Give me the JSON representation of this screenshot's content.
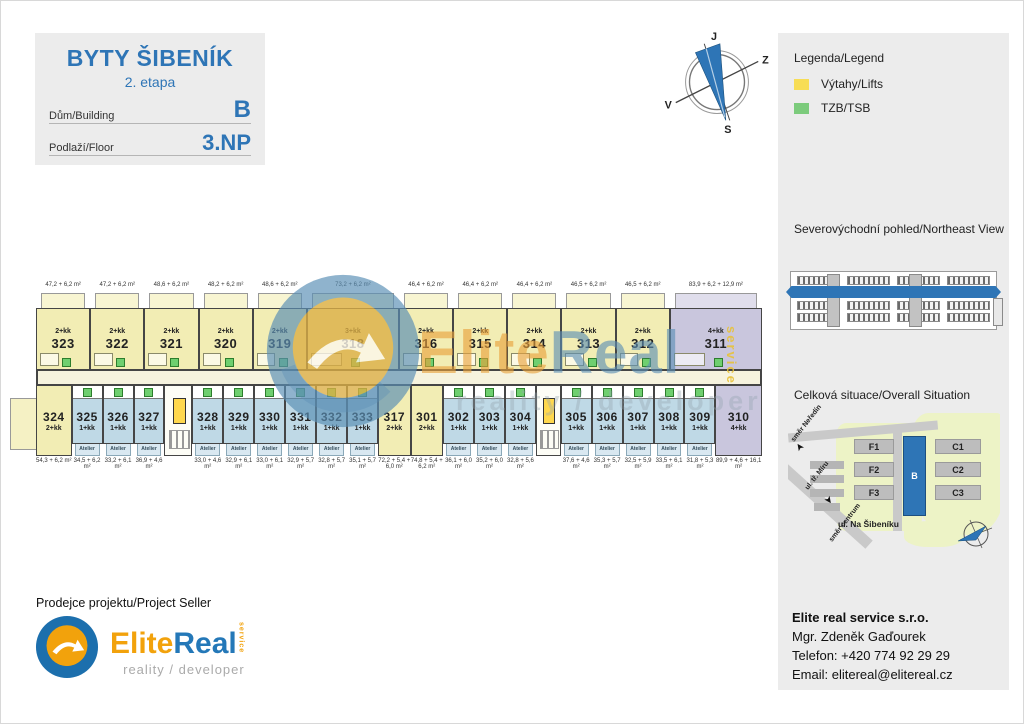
{
  "header": {
    "title": "BYTY ŠIBENÍK",
    "subtitle": "2. etapa",
    "building_label": "Dům/Building",
    "building_value": "B",
    "floor_label": "Podlaží/Floor",
    "floor_value": "3.NP"
  },
  "compass": {
    "top": "J",
    "right": "Z",
    "bottom": "S",
    "left": "V"
  },
  "legend": {
    "title": "Legenda/Legend",
    "items": [
      {
        "label": "Výtahy/Lifts",
        "color": "#f7dd55"
      },
      {
        "label": "TZB/TSB",
        "color": "#7ccb7c"
      }
    ]
  },
  "northeast_view": {
    "title": "Severovýchodní pohled/Northeast View",
    "highlight_color": "#2e75b6"
  },
  "situation": {
    "title": "Celková situace/Overall Situation",
    "street": "ul. Na Šibeníku",
    "directions": {
      "north": "směr Neředín",
      "road": "ul. tř. Míru",
      "south": "směr centrum"
    },
    "buildings": [
      {
        "label": "F1"
      },
      {
        "label": "F2"
      },
      {
        "label": "F3"
      },
      {
        "label": "B",
        "highlight": true
      },
      {
        "label": "C1"
      },
      {
        "label": "C2"
      },
      {
        "label": "C3"
      }
    ],
    "highlight_color": "#2e75b6"
  },
  "seller": {
    "heading": "Prodejce projektu/Project Seller",
    "logo_elite": "Elite",
    "logo_real": "Real",
    "logo_service": "service",
    "logo_tagline": "reality / developer"
  },
  "contact": {
    "company": "Elite real service s.r.o.",
    "name": "Mgr. Zdeněk Gaďourek",
    "phone": "Telefon: +420 774 92 29 29",
    "email": "Email: elitereal@elitereal.cz"
  },
  "plan": {
    "atelier_label": "Atelier",
    "colors": {
      "residential_yellow": "#f2edb4",
      "atelier_blue": "#bfd9e6",
      "large_unit_purple": "#c9c6dd",
      "lift_yellow": "#ffd84d",
      "tzb_green": "#6fcf6f"
    },
    "watermark": {
      "elite": "Elite",
      "real": "Real",
      "service": "service",
      "tagline": "reality / developer"
    },
    "top_units": [
      {
        "number": "323",
        "type": "2+kk",
        "area": "47,2 + 6,2 m²",
        "variant": "yellow",
        "w": 1
      },
      {
        "number": "322",
        "type": "2+kk",
        "area": "47,2 + 6,2 m²",
        "variant": "yellow",
        "w": 1
      },
      {
        "number": "321",
        "type": "2+kk",
        "area": "48,6 + 6,2 m²",
        "variant": "yellow",
        "w": 1
      },
      {
        "number": "320",
        "type": "2+kk",
        "area": "48,2 + 6,2 m²",
        "variant": "yellow",
        "w": 1
      },
      {
        "number": "319",
        "type": "2+kk",
        "area": "48,6 + 6,2 m²",
        "variant": "yellow",
        "w": 1
      },
      {
        "number": "318",
        "type": "3+kk",
        "area": "73,2 + 6,2 m²",
        "variant": "yellow",
        "w": 1.7
      },
      {
        "number": "316",
        "type": "2+kk",
        "area": "46,4 + 6,2 m²",
        "variant": "yellow",
        "w": 1
      },
      {
        "number": "315",
        "type": "2+kk",
        "area": "46,4 + 6,2 m²",
        "variant": "yellow",
        "w": 1
      },
      {
        "number": "314",
        "type": "2+kk",
        "area": "46,4 + 6,2 m²",
        "variant": "yellow",
        "w": 1
      },
      {
        "number": "313",
        "type": "2+kk",
        "area": "46,5 + 6,2 m²",
        "variant": "yellow",
        "w": 1
      },
      {
        "number": "312",
        "type": "2+kk",
        "area": "46,5 + 6,2 m²",
        "variant": "yellow",
        "w": 1
      },
      {
        "number": "311",
        "type": "4+kk",
        "area": "83,9 + 6,2 + 12,9 m²",
        "variant": "purple",
        "w": 1.7
      }
    ],
    "bottom_units": [
      {
        "number": "324",
        "type": "2+kk",
        "area": "54,3 + 6,2 m²",
        "variant": "yellow",
        "atelier": false,
        "w": 1.15
      },
      {
        "number": "325",
        "type": "1+kk",
        "area": "34,5 + 6,2 m²",
        "variant": "blue",
        "atelier": true,
        "w": 1
      },
      {
        "number": "326",
        "type": "1+kk",
        "area": "33,2 + 6,1 m²",
        "variant": "blue",
        "atelier": true,
        "w": 1
      },
      {
        "number": "327",
        "type": "1+kk",
        "area": "36,9 + 4,6 m²",
        "variant": "blue",
        "atelier": true,
        "w": 1
      },
      {
        "core": true,
        "w": 0.9
      },
      {
        "number": "328",
        "type": "1+kk",
        "area": "33,0 + 4,6 m²",
        "variant": "blue",
        "atelier": true,
        "w": 1
      },
      {
        "number": "329",
        "type": "1+kk",
        "area": "32,9 + 6,1 m²",
        "variant": "blue",
        "atelier": true,
        "w": 1
      },
      {
        "number": "330",
        "type": "1+kk",
        "area": "33,0 + 6,1 m²",
        "variant": "blue",
        "atelier": true,
        "w": 1
      },
      {
        "number": "331",
        "type": "1+kk",
        "area": "32,9 + 5,7 m²",
        "variant": "blue",
        "atelier": true,
        "w": 1
      },
      {
        "number": "332",
        "type": "1+kk",
        "area": "32,8 + 5,7 m²",
        "variant": "blue",
        "atelier": true,
        "w": 1
      },
      {
        "number": "333",
        "type": "1+kk",
        "area": "35,1 + 5,7 m²",
        "variant": "blue",
        "atelier": true,
        "w": 1
      },
      {
        "number": "317",
        "type": "2+kk",
        "area": "72,2 + 5,4 + 6,0 m²",
        "variant": "yellow",
        "atelier": false,
        "w": 1.05
      },
      {
        "number": "301",
        "type": "2+kk",
        "area": "74,8 + 5,4 + 6,2 m²",
        "variant": "yellow",
        "atelier": false,
        "w": 1.05
      },
      {
        "number": "302",
        "type": "1+kk",
        "area": "36,1 + 6,0 m²",
        "variant": "blue",
        "atelier": true,
        "w": 1
      },
      {
        "number": "303",
        "type": "1+kk",
        "area": "35,2 + 6,0 m²",
        "variant": "blue",
        "atelier": true,
        "w": 1
      },
      {
        "number": "304",
        "type": "1+kk",
        "area": "32,8 + 5,6 m²",
        "variant": "blue",
        "atelier": true,
        "w": 1
      },
      {
        "core": true,
        "w": 0.8
      },
      {
        "number": "305",
        "type": "1+kk",
        "area": "37,6 + 4,6 m²",
        "variant": "blue",
        "atelier": true,
        "w": 1
      },
      {
        "number": "306",
        "type": "1+kk",
        "area": "35,3 + 5,7 m²",
        "variant": "blue",
        "atelier": true,
        "w": 1
      },
      {
        "number": "307",
        "type": "1+kk",
        "area": "32,5 + 5,9 m²",
        "variant": "blue",
        "atelier": true,
        "w": 1
      },
      {
        "number": "308",
        "type": "1+kk",
        "area": "33,5 + 6,1 m²",
        "variant": "blue",
        "atelier": true,
        "w": 1
      },
      {
        "number": "309",
        "type": "1+kk",
        "area": "31,8 + 5,3 m²",
        "variant": "blue",
        "atelier": true,
        "w": 1
      },
      {
        "number": "310",
        "type": "4+kk",
        "area": "89,9 + 4,6 + 16,1 m²",
        "variant": "purple",
        "atelier": false,
        "w": 1.5
      }
    ]
  }
}
